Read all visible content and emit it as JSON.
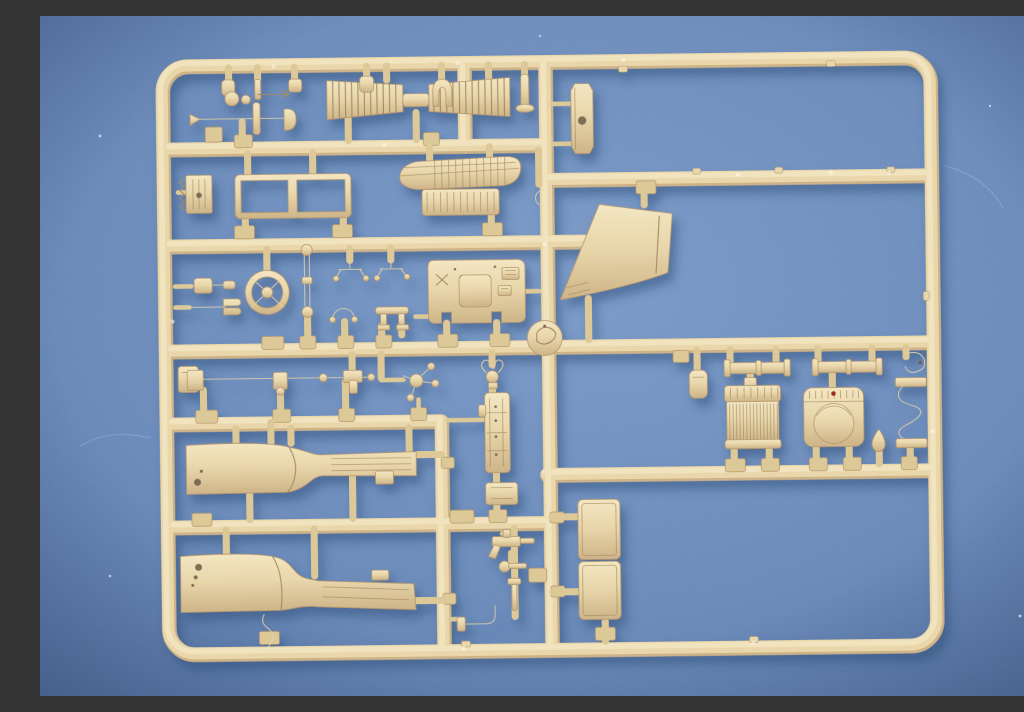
{
  "scene": {
    "description": "Photograph of an unassembled sand-tan injection-molded model kit sprue (parts runner) lying on a blue paper-textured mat",
    "caption": "Tan plastic model-kit sprue with truck parts (fenders, radiator, grille, steering wheel, dashboard) on a blue background",
    "background": "blue textured mat, lighter near center, darker toward corners",
    "sprue_color_name": "sand tan plastic",
    "sprue_transform": "rotate(-0.7 510 340)"
  },
  "colors": {
    "mat_light": "#6e90c2",
    "mat_mid": "#5c7fb3",
    "mat_dark": "#46689d",
    "plastic_base": "#e9d7ab",
    "plastic_mid": "#ddc897",
    "plastic_solid": "#e7d4a6",
    "plastic_hi": "#f3e6c2",
    "plastic_lo": "#cdb488",
    "plastic_edge": "#b3956a",
    "plastic_line": "#a28a60",
    "hole_dark": "#6b5d45",
    "red_marking": "#9c2c1c",
    "shadow_blue": "#2b4876"
  },
  "parts": [
    {
      "name": "sprue-frame",
      "desc": "rounded rectangular outer runner frame"
    },
    {
      "name": "louver-vent-left",
      "desc": "slatted bonnet louver panel, left"
    },
    {
      "name": "louver-vent-right",
      "desc": "slatted bonnet louver panel, right"
    },
    {
      "name": "intake-grille",
      "desc": "curved mesh engine grille with vertical slats and ribbed apron"
    },
    {
      "name": "window-frame",
      "desc": "two-pane windscreen frame"
    },
    {
      "name": "ratchet-plate",
      "desc": "small toothed plate with hole on left rail"
    },
    {
      "name": "ball-joint-lever",
      "desc": "ball head lever with socket"
    },
    {
      "name": "fork-pin",
      "desc": "small forked pin with thin rod"
    },
    {
      "name": "control-rod",
      "desc": "long thin control rod with chevron tip"
    },
    {
      "name": "dome-cap",
      "desc": "small arched cap"
    },
    {
      "name": "flanged-pin",
      "desc": "pin with bottom flange"
    },
    {
      "name": "retainer-clip",
      "desc": "open C retainer clip"
    },
    {
      "name": "steering-wheel",
      "desc": "four-spoke steering wheel"
    },
    {
      "name": "shock-link",
      "desc": "double-rod link with eyelets"
    },
    {
      "name": "clevis-bracket-a",
      "desc": "small angled bracket with feet"
    },
    {
      "name": "clevis-bracket-b",
      "desc": "small angled bracket with feet"
    },
    {
      "name": "u-clamp",
      "desc": "horseshoe clamp"
    },
    {
      "name": "pedestal-bracket",
      "desc": "small stool-shaped pedestal"
    },
    {
      "name": "dashboard",
      "desc": "instrument panel with recessed cluster opening, X emboss and switch boxes"
    },
    {
      "name": "crank-disc",
      "desc": "round disc with molded crank detail at rail junction"
    },
    {
      "name": "hood-scoop",
      "desc": "large trapezoidal cowl / hood scoop"
    },
    {
      "name": "side-bracket-plate",
      "desc": "elongated chamfered plate with hole"
    },
    {
      "name": "left-pad-part",
      "desc": "small rectangular pad on left rail"
    },
    {
      "name": "tie-rod",
      "desc": "long steering tie rod with end fittings"
    },
    {
      "name": "t-block",
      "desc": "small T-shaped block"
    },
    {
      "name": "steering-knuckle",
      "desc": "three-arm steering knuckle"
    },
    {
      "name": "wing-clamp",
      "desc": "ring clamp with two wing loops"
    },
    {
      "name": "chassis-member",
      "desc": "tall riveted chassis plate"
    },
    {
      "name": "connector-pad-part",
      "desc": "rectangular connector pad"
    },
    {
      "name": "lever-assembly",
      "desc": "pedal and lever cluster"
    },
    {
      "name": "ball-knob",
      "desc": "gear knob with shaft"
    },
    {
      "name": "fastening-pin",
      "desc": "flat-head fastening pin"
    },
    {
      "name": "elbow-pipe",
      "desc": "L-shaped pipe with flange"
    },
    {
      "name": "swan-neck-pipe",
      "desc": "small S-curved pipe below rear fender"
    },
    {
      "name": "axle-rod-front",
      "desc": "stepped axle rod with collars"
    },
    {
      "name": "axle-rod-rear",
      "desc": "stepped axle rod with collars"
    },
    {
      "name": "tow-hook",
      "desc": "curled tow hook"
    },
    {
      "name": "radiator",
      "desc": "ribbed radiator core with header and filler neck"
    },
    {
      "name": "radiator-shell",
      "desc": "radiator cowl shell with large round opening and red paint dot"
    },
    {
      "name": "teardrop-part",
      "desc": "small teardrop lamp body"
    },
    {
      "name": "exhaust-pipe",
      "desc": "S-shaped exhaust pipe spanning to right rail"
    },
    {
      "name": "canister-part",
      "desc": "small round-top canister"
    },
    {
      "name": "stowage-door",
      "desc": "two stacked rectangular stowage door panels"
    },
    {
      "name": "front-fender",
      "desc": "front fender blade with running board and lightening holes"
    },
    {
      "name": "rear-fender",
      "desc": "rear fender blade with sloped running board and holes"
    }
  ]
}
